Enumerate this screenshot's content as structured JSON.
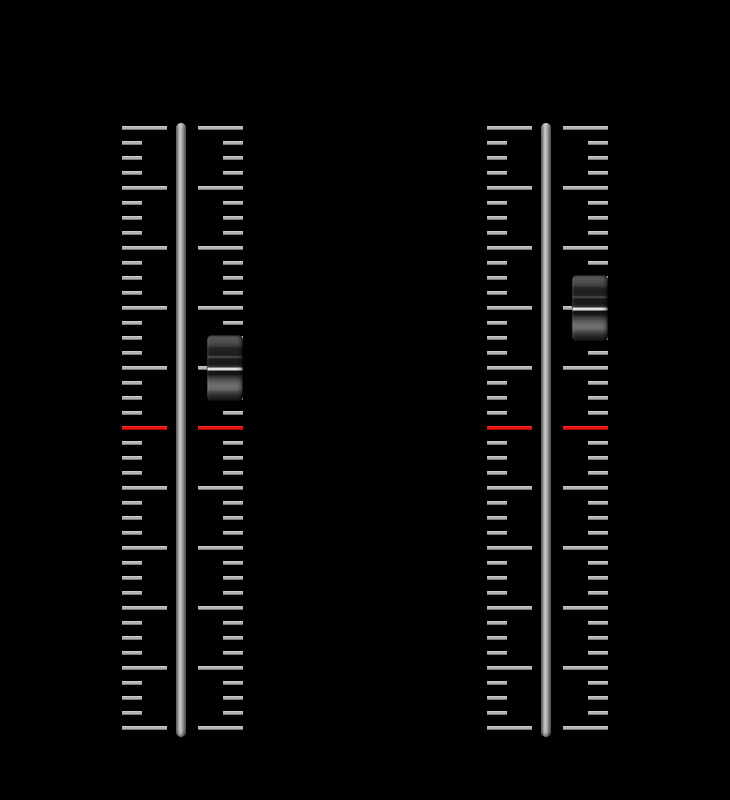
{
  "window": {
    "background_color": "#000000"
  },
  "scale": {
    "tick_count": 41,
    "tick_spacing_px": 15,
    "major_every": 4,
    "red_tick_index": 20,
    "major_tick_length_px": 45,
    "minor_tick_length_px": 20,
    "tick_thickness_px": 4,
    "tick_color": "#b2b2b2",
    "red_tick_color": "#ee1111"
  },
  "sliders": [
    {
      "name": "left-fader",
      "orientation": "vertical",
      "thumb_tick_index": 16
    },
    {
      "name": "right-fader",
      "orientation": "vertical",
      "thumb_tick_index": 12
    }
  ]
}
